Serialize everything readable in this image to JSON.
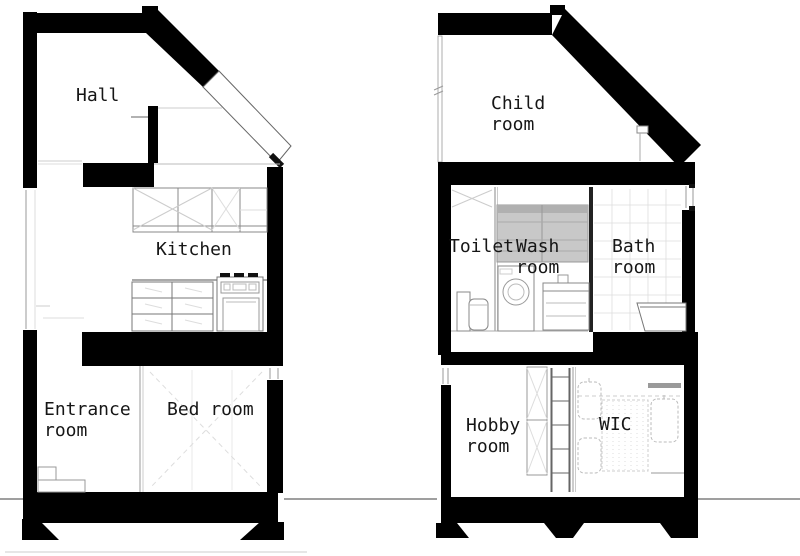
{
  "drawing": {
    "type": "architectural-cross-section",
    "sections": [
      {
        "id": "left-building",
        "rooms": [
          {
            "id": "hall",
            "label": "Hall"
          },
          {
            "id": "kitchen",
            "label": "Kitchen"
          },
          {
            "id": "entrance",
            "label": "Entrance\nroom"
          },
          {
            "id": "bedroom",
            "label": "Bed room"
          }
        ]
      },
      {
        "id": "right-building",
        "rooms": [
          {
            "id": "child",
            "label": "Child\nroom"
          },
          {
            "id": "toilet",
            "label": "Toilet"
          },
          {
            "id": "wash",
            "label": "Wash\nroom"
          },
          {
            "id": "bath",
            "label": "Bath\nroom"
          },
          {
            "id": "hobby",
            "label": "Hobby\nroom"
          },
          {
            "id": "wic",
            "label": "WIC"
          }
        ]
      }
    ],
    "colors": {
      "wall": "#000000",
      "background": "#ffffff",
      "cabinet_fill": "#c8c8c8",
      "thin_line": "#999999",
      "text": "#161616"
    }
  }
}
